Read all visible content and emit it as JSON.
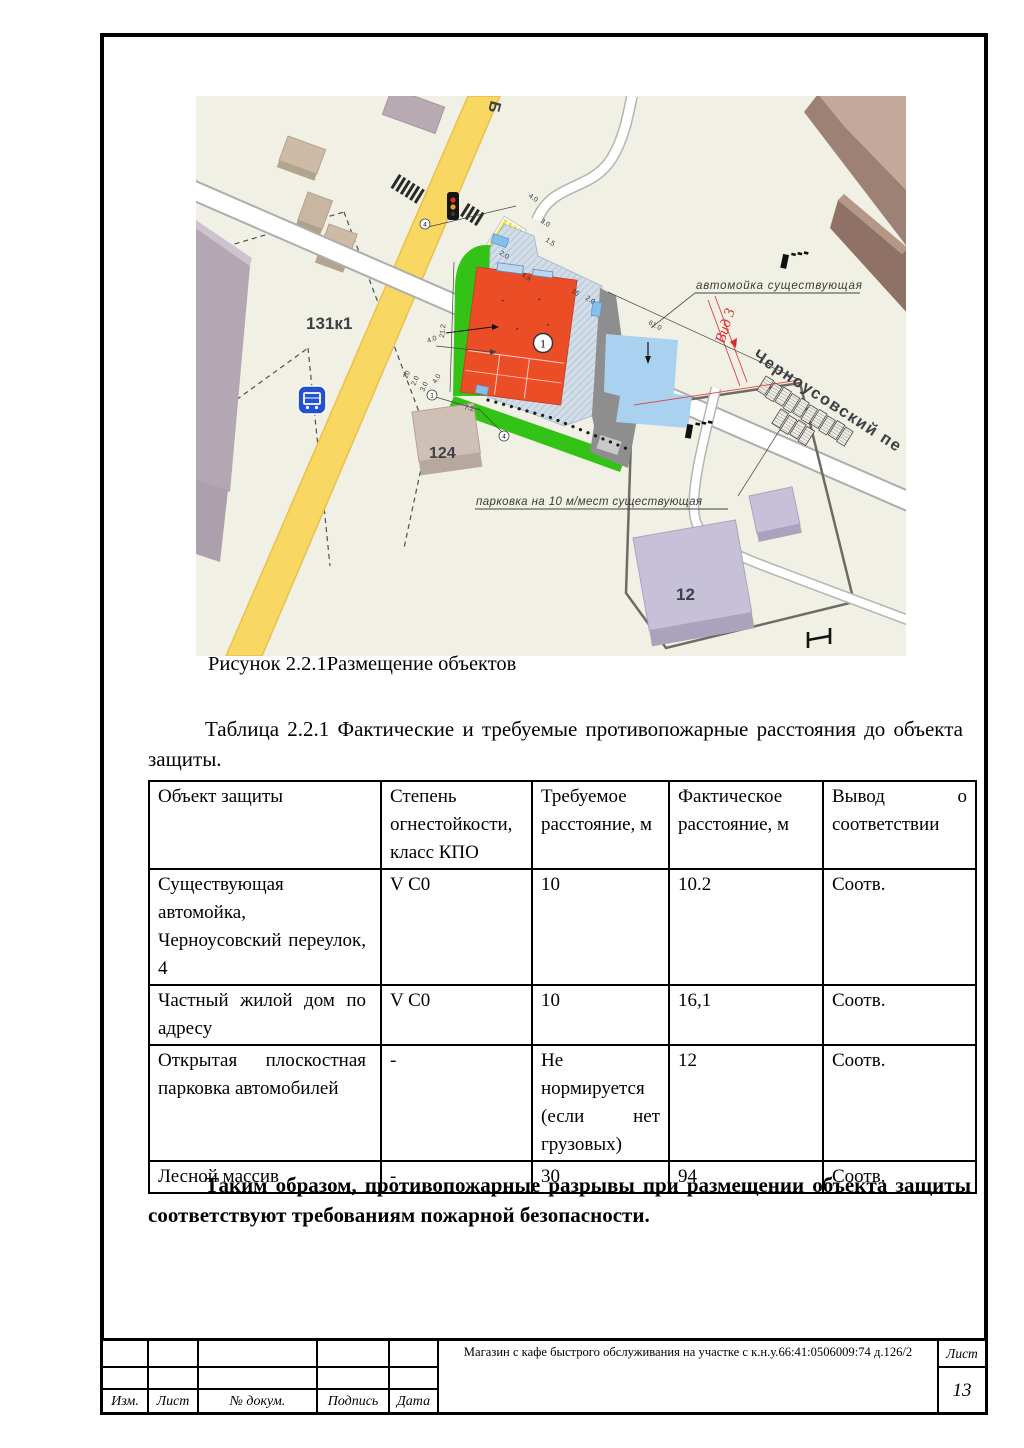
{
  "page": {
    "figure_caption": "Рисунок 2.2.1Размещение объектов",
    "table_intro": "Таблица 2.2.1 Фактические и требуемые противопожарные расстояния до объекта защиты.",
    "conclusion": "Таким образом, противопожарные разрывы при размещении объекта защиты соответствуют требованиям пожарной безопасности."
  },
  "map": {
    "labels": {
      "street_top": "Б",
      "block_131": "131к1",
      "house_124": "124",
      "house_12": "12",
      "street_main": "Черноусовский пе",
      "carwash": "автомойка существующая",
      "parking": "парковка  на 10 м/мест существующая",
      "view": "Вид 3",
      "building_marker": "1"
    },
    "dimensions": [
      "4.0",
      "3.0",
      "1.5",
      "2.0",
      "4.9",
      "15",
      "2.0",
      "61.0",
      "21.2",
      "4.0",
      "4.0",
      "20",
      "2.0",
      "3.0",
      "7.2"
    ],
    "circles": [
      "4",
      "4",
      "1"
    ],
    "colors": {
      "map_bg": "#f1f0e4",
      "lawn_green": "#33c317",
      "building_orange": "#eb4e27",
      "site_hatch_blue": "#d2dde8",
      "pond_blue": "#a9d2f0",
      "asphalt_grey": "#8e8e8e",
      "road_yellow": "#f8d862",
      "accent_red": "#e0262e"
    }
  },
  "table": {
    "headers": [
      "Объект защиты",
      "Степень огнестойкости, класс КПО",
      "Требуемое расстояние, м",
      "Фактическое расстояние, м",
      "Вывод о соответствии"
    ],
    "rows": [
      {
        "cells": [
          "Существующая автомойка, Черноусовский переулок, 4",
          "V С0",
          "10",
          "10.2",
          "Соотв."
        ]
      },
      {
        "cells": [
          "Частный жилой дом по адресу",
          "V С0",
          "10",
          "16,1",
          "Соотв."
        ]
      },
      {
        "cells": [
          "Открытая плоскостная парковка автомобилей",
          "-",
          "Не нормируется (если нет грузовых)",
          "12",
          "Соотв."
        ]
      },
      {
        "cells": [
          "Лесной массив",
          "-",
          "30",
          "94",
          "Соотв."
        ]
      }
    ]
  },
  "footer": {
    "cols": [
      "Изм.",
      "Лист",
      "№ докум.",
      "Подпись",
      "Дата"
    ],
    "doc_title": "Магазин с кафе быстрого обслуживания на участке с к.н.у.66:41:0506009:74 д.126/2",
    "sheet_label": "Лист",
    "sheet_number": "13"
  }
}
